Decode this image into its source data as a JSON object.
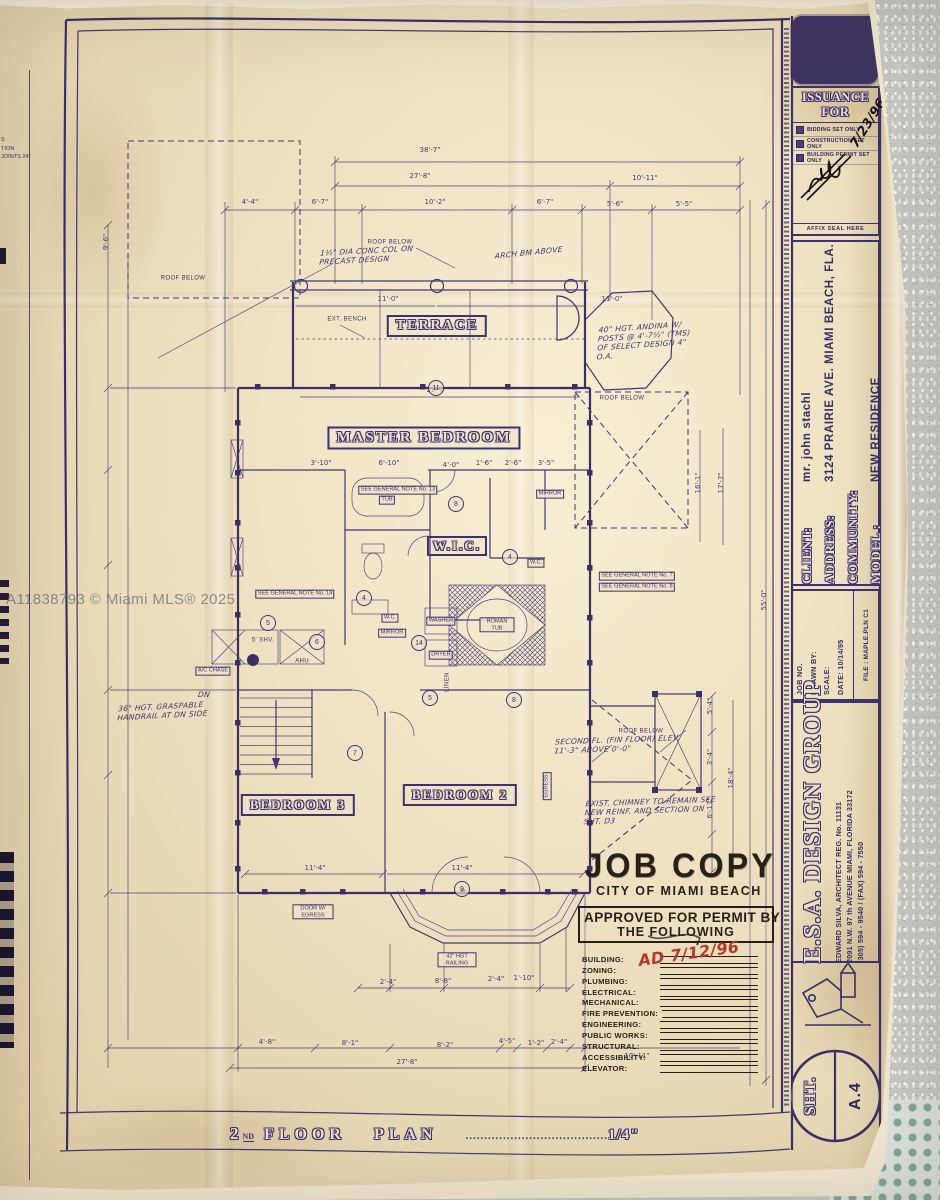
{
  "watermark": "A11838793 © Miami MLS® 2025",
  "title_bar": {
    "num": "2",
    "sup": "ND",
    "word1": "FLOOR",
    "word2": "PLAN",
    "dots": "......................................",
    "scale": "1/4\""
  },
  "issuance": {
    "title": "ISSUANCE FOR",
    "options": [
      "BIDDING SET ONLY",
      "CONSTRUCTION  SET ONLY",
      "BUILDING PERMIT SET ONLY"
    ],
    "date": "7/23/96",
    "seal": "AFFIX SEAL HERE"
  },
  "client_block": {
    "rows": [
      {
        "label": "CLIENT:",
        "value": "mr. john stachl"
      },
      {
        "label": "ADDRESS:",
        "value": "3124 PRAIRIE AVE. MIAMI BEACH, FLA."
      },
      {
        "label": "COMMUNITY:",
        "value": ""
      },
      {
        "label": "MODEL :",
        "value": "NEW RESIDENCE"
      }
    ]
  },
  "job_block": {
    "lines": [
      "JOB NO.",
      "DRAWN BY:",
      "SCALE:",
      "DATE: 10/14/95"
    ],
    "file": "FILE : MAPLE.PLN C1"
  },
  "firm": {
    "name": "E.S.A. DESIGN GROUP",
    "architect": "EDWARD SILVA, ARCHITECT REG. No. 11131",
    "address": "2091 N.W. 97 th AVENUE MIAMI, FLORIDA 33172",
    "phone": "(305) 594 - 9540 / (FAX) 594 - 7550"
  },
  "sheet": {
    "label": "SHT.",
    "number": "A.4"
  },
  "stamp": {
    "line1": "JOB COPY",
    "line2": "CITY OF MIAMI BEACH",
    "approved": "APPROVED FOR PERMIT BY",
    "approved2": "THE FOLLOWING",
    "departments": [
      "BUILDING:",
      "ZONING:",
      "PLUMBING:",
      "ELECTRICAL:",
      "MECHANICAL:",
      "FIRE PREVENTION:",
      "ENGINEERING:",
      "PUBLIC WORKS:",
      "STRUCTURAL:",
      "ACCESSIBILITY:",
      "ELEVATOR:"
    ],
    "red_note": "AD 7/12/96"
  },
  "rooms": {
    "terrace": "TERRACE",
    "master": "MASTER BEDROOM",
    "wic": "W.I.C.",
    "bed3": "BEDROOM 3",
    "bed2": "BEDROOM 2"
  },
  "edge_fragments": [
    "S",
    "TION",
    "JOINTS 24\""
  ],
  "plan": {
    "labels": [
      {
        "x": 390,
        "y": 243,
        "t": "ROOF BELOW",
        "p": 1
      },
      {
        "x": 183,
        "y": 279,
        "t": "ROOF BELOW",
        "p": 1
      },
      {
        "x": 622,
        "y": 399,
        "t": "ROOF BELOW",
        "p": 1
      },
      {
        "x": 641,
        "y": 732,
        "t": "ROOF BELOW",
        "p": 1
      },
      {
        "x": 347,
        "y": 320,
        "t": "EXT. BENCH",
        "p": 1
      },
      {
        "x": 398,
        "y": 490,
        "t": "SEE GENERAL NOTE No. 13"
      },
      {
        "x": 295,
        "y": 594,
        "t": "SEE GENERAL NOTE No. 14"
      },
      {
        "x": 637,
        "y": 576,
        "t": "SEE GENERAL NOTE No. 7"
      },
      {
        "x": 637,
        "y": 587,
        "t": "SEE GENERAL NOTE No. 8"
      },
      {
        "x": 387,
        "y": 500,
        "t": "TUB"
      },
      {
        "x": 550,
        "y": 494,
        "t": "MIRROR"
      },
      {
        "x": 536,
        "y": 563,
        "t": "W.C."
      },
      {
        "x": 390,
        "y": 618,
        "t": "W.C."
      },
      {
        "x": 392,
        "y": 633,
        "t": "MIRROR"
      },
      {
        "x": 497,
        "y": 625,
        "t": "ROMAN TUB",
        "w": 30
      },
      {
        "x": 441,
        "y": 621,
        "t": "WASHER"
      },
      {
        "x": 441,
        "y": 655,
        "t": "DRYER"
      },
      {
        "x": 263,
        "y": 641,
        "t": "5' SHV.",
        "p": 1
      },
      {
        "x": 302,
        "y": 662,
        "t": "AHU",
        "p": 1
      },
      {
        "x": 213,
        "y": 671,
        "t": "A/C CHASE"
      },
      {
        "x": 313,
        "y": 912,
        "t": "DOOR W/ EGRESS",
        "w": 36
      },
      {
        "x": 457,
        "y": 960,
        "t": "42\" HGT RAILING",
        "w": 34
      },
      {
        "x": 547,
        "y": 786,
        "t": "EGRESS",
        "r": 1
      },
      {
        "x": 448,
        "y": 682,
        "t": "LINEN",
        "r": 1,
        "p": 1
      }
    ],
    "dims": [
      {
        "x": 430,
        "y": 152,
        "t": "38'-7\""
      },
      {
        "x": 420,
        "y": 178,
        "t": "27'-8\""
      },
      {
        "x": 645,
        "y": 180,
        "t": "10'-11\""
      },
      {
        "x": 250,
        "y": 204,
        "t": "4'-4\""
      },
      {
        "x": 320,
        "y": 204,
        "t": "6'-7\""
      },
      {
        "x": 435,
        "y": 204,
        "t": "10'-2\""
      },
      {
        "x": 545,
        "y": 204,
        "t": "6'-7\""
      },
      {
        "x": 615,
        "y": 206,
        "t": "5'-6\""
      },
      {
        "x": 684,
        "y": 206,
        "t": "5'-5\""
      },
      {
        "x": 388,
        "y": 301,
        "t": "11'-0\""
      },
      {
        "x": 612,
        "y": 301,
        "t": "11'-0\""
      },
      {
        "x": 437,
        "y": 392,
        "t": "22'-0\""
      },
      {
        "x": 321,
        "y": 465,
        "t": "3'-10\""
      },
      {
        "x": 389,
        "y": 465,
        "t": "6'-10\""
      },
      {
        "x": 451,
        "y": 467,
        "t": "4'-0\""
      },
      {
        "x": 484,
        "y": 465,
        "t": "1'-6\""
      },
      {
        "x": 513,
        "y": 465,
        "t": "2'-6\""
      },
      {
        "x": 546,
        "y": 465,
        "t": "3'-5\""
      },
      {
        "x": 315,
        "y": 870,
        "t": "11'-4\""
      },
      {
        "x": 462,
        "y": 870,
        "t": "11'-4\""
      },
      {
        "x": 388,
        "y": 984,
        "t": "2'-4\""
      },
      {
        "x": 443,
        "y": 983,
        "t": "8'-8\""
      },
      {
        "x": 496,
        "y": 981,
        "t": "2'-4\""
      },
      {
        "x": 524,
        "y": 980,
        "t": "1'-10\""
      },
      {
        "x": 267,
        "y": 1044,
        "t": "4'-8\""
      },
      {
        "x": 350,
        "y": 1045,
        "t": "8'-1\""
      },
      {
        "x": 445,
        "y": 1047,
        "t": "8'-2\""
      },
      {
        "x": 507,
        "y": 1043,
        "t": "4'-5\""
      },
      {
        "x": 536,
        "y": 1045,
        "t": "1'-2\""
      },
      {
        "x": 559,
        "y": 1044,
        "t": "2'-4\""
      },
      {
        "x": 407,
        "y": 1064,
        "t": "27'-8\""
      },
      {
        "x": 637,
        "y": 1058,
        "t": "10'-11\""
      },
      {
        "x": 108,
        "y": 242,
        "t": "9'-6\"",
        "r": 1
      },
      {
        "x": 700,
        "y": 483,
        "t": "16'-1\"",
        "r": 1
      },
      {
        "x": 723,
        "y": 483,
        "t": "17'-7\"",
        "r": 1
      },
      {
        "x": 712,
        "y": 706,
        "t": "5'-4\"",
        "r": 1
      },
      {
        "x": 712,
        "y": 757,
        "t": "3'-4\"",
        "r": 1
      },
      {
        "x": 712,
        "y": 808,
        "t": "6'-11\"",
        "r": 1
      },
      {
        "x": 733,
        "y": 778,
        "t": "18'-4\"",
        "r": 1
      },
      {
        "x": 766,
        "y": 600,
        "t": "55'-0\"",
        "r": 1
      }
    ],
    "bubbles": [
      {
        "x": 436,
        "y": 388,
        "t": "11"
      },
      {
        "x": 456,
        "y": 504,
        "t": "8"
      },
      {
        "x": 510,
        "y": 557,
        "t": "4"
      },
      {
        "x": 364,
        "y": 598,
        "t": "4"
      },
      {
        "x": 419,
        "y": 643,
        "t": "14"
      },
      {
        "x": 268,
        "y": 623,
        "t": "5"
      },
      {
        "x": 317,
        "y": 642,
        "t": "6"
      },
      {
        "x": 355,
        "y": 753,
        "t": "7"
      },
      {
        "x": 462,
        "y": 889,
        "t": "9"
      },
      {
        "x": 514,
        "y": 700,
        "t": "8"
      },
      {
        "x": 430,
        "y": 698,
        "t": "5"
      }
    ],
    "notes": [
      {
        "x": 320,
        "y": 246,
        "w": 100,
        "rot": -3,
        "t": "1½\" DIA CONC COL ON PRECAST DESIGN"
      },
      {
        "x": 495,
        "y": 248,
        "w": 70,
        "rot": -6,
        "t": "ARCH BM ABOVE"
      },
      {
        "x": 598,
        "y": 322,
        "w": 100,
        "rot": -4,
        "t": "40\" HGT. ANDINA W/ POSTS @ 4'-7½\" (TMS) OF SELECT DESIGN 4\" O.A."
      },
      {
        "x": 118,
        "y": 702,
        "w": 90,
        "rot": -3,
        "t": "36\" HGT. GRASPABLE HANDRAIL AT DN SIDE"
      },
      {
        "x": 555,
        "y": 735,
        "w": 140,
        "rot": -2,
        "t": "SECOND FL. (FIN FLOOR) ELEV. 11'-3\" ABOVE 0'-0\""
      },
      {
        "x": 585,
        "y": 797,
        "w": 130,
        "rot": -2,
        "t": "EXIST. CHIMNEY TO REMAIN SEE NEW REINF. AND SECTION ON SHT. D3"
      },
      {
        "x": 198,
        "y": 690,
        "w": 30,
        "rot": 0,
        "t": "DN"
      }
    ]
  }
}
